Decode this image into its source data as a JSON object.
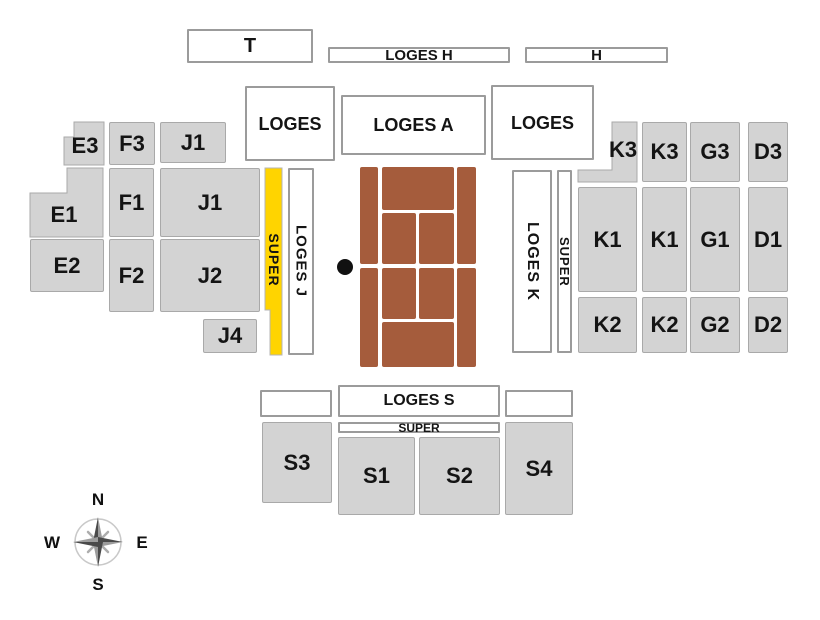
{
  "title": "Tennis stadium seating plan",
  "colors": {
    "background": "#FFFFFF",
    "section_fill": "#D3D3D3",
    "section_border": "#A9A9A9",
    "loge_fill": "#FFFFFF",
    "loge_border": "#9B9B9B",
    "super_fill": "#FFD400",
    "clay": "#A55C3C",
    "label_text": "#141414",
    "net_dot": "#111111"
  },
  "sections": [
    {
      "id": "tribune-t",
      "label": "T",
      "kind": "loge",
      "x": 187,
      "y": 29,
      "w": 126,
      "h": 34,
      "fs": 20
    },
    {
      "id": "loges-h",
      "label": "LOGES H",
      "kind": "loge",
      "x": 328,
      "y": 47,
      "w": 182,
      "h": 16,
      "fs": 15
    },
    {
      "id": "tribune-h",
      "label": "H",
      "kind": "loge",
      "x": 525,
      "y": 47,
      "w": 143,
      "h": 16,
      "fs": 15
    },
    {
      "id": "loges-nw",
      "label": "LOGES",
      "kind": "loge",
      "x": 245,
      "y": 86,
      "w": 90,
      "h": 75,
      "fs": 18
    },
    {
      "id": "loges-a",
      "label": "LOGES A",
      "kind": "loge",
      "x": 341,
      "y": 95,
      "w": 145,
      "h": 60,
      "fs": 18
    },
    {
      "id": "loges-ne",
      "label": "LOGES",
      "kind": "loge",
      "x": 491,
      "y": 85,
      "w": 103,
      "h": 75,
      "fs": 18
    },
    {
      "id": "e3",
      "label": "E3",
      "kind": "section",
      "shape": "poly",
      "points": "64,137 74,137 74,122 104,122 104,165 64,165",
      "lx": 85,
      "ly": 146,
      "fs": 22
    },
    {
      "id": "f3",
      "label": "F3",
      "kind": "section",
      "x": 109,
      "y": 122,
      "w": 46,
      "h": 43,
      "fs": 22
    },
    {
      "id": "j1-upper",
      "label": "J1",
      "kind": "section",
      "x": 160,
      "y": 122,
      "w": 66,
      "h": 41,
      "fs": 22
    },
    {
      "id": "e1",
      "label": "E1",
      "kind": "section",
      "shape": "poly",
      "points": "30,193 67,193 67,168 103,168 103,237 30,237",
      "lx": 64,
      "ly": 215,
      "fs": 22
    },
    {
      "id": "f1",
      "label": "F1",
      "kind": "section",
      "x": 109,
      "y": 168,
      "w": 45,
      "h": 69,
      "fs": 22
    },
    {
      "id": "j1",
      "label": "J1",
      "kind": "section",
      "x": 160,
      "y": 168,
      "w": 100,
      "h": 69,
      "fs": 22
    },
    {
      "id": "e2",
      "label": "E2",
      "kind": "section",
      "x": 30,
      "y": 239,
      "w": 74,
      "h": 53,
      "fs": 22
    },
    {
      "id": "f2",
      "label": "F2",
      "kind": "section",
      "x": 109,
      "y": 239,
      "w": 45,
      "h": 73,
      "fs": 22
    },
    {
      "id": "j2",
      "label": "J2",
      "kind": "section",
      "x": 160,
      "y": 239,
      "w": 100,
      "h": 73,
      "fs": 22
    },
    {
      "id": "j4",
      "label": "J4",
      "kind": "section",
      "x": 203,
      "y": 319,
      "w": 54,
      "h": 34,
      "fs": 22
    },
    {
      "id": "super-west",
      "label": "SUPER",
      "kind": "super",
      "shape": "poly",
      "points": "265,168 282,168 282,355 270,355 270,310 265,310",
      "lx": 274,
      "ly": 260,
      "fs": 14,
      "vertical": true
    },
    {
      "id": "loges-j",
      "label": "LOGES J",
      "kind": "loge",
      "x": 288,
      "y": 168,
      "w": 26,
      "h": 187,
      "fs": 15,
      "vertical": true
    },
    {
      "id": "loges-k",
      "label": "LOGES K",
      "kind": "loge",
      "x": 512,
      "y": 170,
      "w": 40,
      "h": 183,
      "fs": 16,
      "vertical": true
    },
    {
      "id": "super-east",
      "label": "SUPER",
      "kind": "loge",
      "x": 557,
      "y": 170,
      "w": 15,
      "h": 183,
      "fs": 13,
      "vertical": true
    },
    {
      "id": "k3-west",
      "label": "K3",
      "kind": "section",
      "shape": "poly",
      "points": "612,122 637,122 637,182 578,182 578,170 612,170",
      "lx": 623,
      "ly": 150,
      "fs": 22
    },
    {
      "id": "k3-east",
      "label": "K3",
      "kind": "section",
      "x": 642,
      "y": 122,
      "w": 45,
      "h": 60,
      "fs": 22
    },
    {
      "id": "g3",
      "label": "G3",
      "kind": "section",
      "x": 690,
      "y": 122,
      "w": 50,
      "h": 60,
      "fs": 22
    },
    {
      "id": "d3",
      "label": "D3",
      "kind": "section",
      "x": 748,
      "y": 122,
      "w": 40,
      "h": 60,
      "fs": 22
    },
    {
      "id": "k1-west",
      "label": "K1",
      "kind": "section",
      "x": 578,
      "y": 187,
      "w": 59,
      "h": 105,
      "fs": 22
    },
    {
      "id": "k1-east",
      "label": "K1",
      "kind": "section",
      "x": 642,
      "y": 187,
      "w": 45,
      "h": 105,
      "fs": 22
    },
    {
      "id": "g1",
      "label": "G1",
      "kind": "section",
      "x": 690,
      "y": 187,
      "w": 50,
      "h": 105,
      "fs": 22
    },
    {
      "id": "d1",
      "label": "D1",
      "kind": "section",
      "x": 748,
      "y": 187,
      "w": 40,
      "h": 105,
      "fs": 22
    },
    {
      "id": "k2-west",
      "label": "K2",
      "kind": "section",
      "x": 578,
      "y": 297,
      "w": 59,
      "h": 56,
      "fs": 22
    },
    {
      "id": "k2-east",
      "label": "K2",
      "kind": "section",
      "x": 642,
      "y": 297,
      "w": 45,
      "h": 56,
      "fs": 22
    },
    {
      "id": "g2",
      "label": "G2",
      "kind": "section",
      "x": 690,
      "y": 297,
      "w": 50,
      "h": 56,
      "fs": 22
    },
    {
      "id": "d2",
      "label": "D2",
      "kind": "section",
      "x": 748,
      "y": 297,
      "w": 40,
      "h": 56,
      "fs": 22
    },
    {
      "id": "loge-s-west",
      "label": "",
      "kind": "loge",
      "x": 260,
      "y": 390,
      "w": 72,
      "h": 27
    },
    {
      "id": "loges-s",
      "label": "LOGES S",
      "kind": "loge",
      "x": 338,
      "y": 385,
      "w": 162,
      "h": 32,
      "fs": 16
    },
    {
      "id": "loge-s-east",
      "label": "",
      "kind": "loge",
      "x": 505,
      "y": 390,
      "w": 68,
      "h": 27
    },
    {
      "id": "super-south",
      "label": "SUPER",
      "kind": "loge",
      "x": 338,
      "y": 422,
      "w": 162,
      "h": 11,
      "fs": 12
    },
    {
      "id": "s3",
      "label": "S3",
      "kind": "section",
      "x": 262,
      "y": 422,
      "w": 70,
      "h": 81,
      "fs": 22
    },
    {
      "id": "s1",
      "label": "S1",
      "kind": "section",
      "x": 338,
      "y": 437,
      "w": 77,
      "h": 78,
      "fs": 22
    },
    {
      "id": "s2",
      "label": "S2",
      "kind": "section",
      "x": 419,
      "y": 437,
      "w": 81,
      "h": 78,
      "fs": 22
    },
    {
      "id": "s4",
      "label": "S4",
      "kind": "section",
      "x": 505,
      "y": 422,
      "w": 68,
      "h": 93,
      "fs": 22
    }
  ],
  "court": {
    "segments": [
      {
        "name": "alley-left-north",
        "x": 360,
        "y": 167,
        "w": 18,
        "h": 97
      },
      {
        "name": "backcourt-north",
        "x": 382,
        "y": 167,
        "w": 72,
        "h": 43
      },
      {
        "name": "service-nw",
        "x": 382,
        "y": 213,
        "w": 34,
        "h": 51
      },
      {
        "name": "service-ne",
        "x": 419,
        "y": 213,
        "w": 35,
        "h": 51
      },
      {
        "name": "alley-right-north",
        "x": 457,
        "y": 167,
        "w": 19,
        "h": 97
      },
      {
        "name": "alley-left-south",
        "x": 360,
        "y": 268,
        "w": 18,
        "h": 99
      },
      {
        "name": "service-sw",
        "x": 382,
        "y": 268,
        "w": 34,
        "h": 51
      },
      {
        "name": "service-se",
        "x": 419,
        "y": 268,
        "w": 35,
        "h": 51
      },
      {
        "name": "backcourt-south",
        "x": 382,
        "y": 322,
        "w": 72,
        "h": 45
      },
      {
        "name": "alley-right-south",
        "x": 457,
        "y": 268,
        "w": 19,
        "h": 99
      }
    ],
    "net_dot": {
      "cx": 345,
      "cy": 267,
      "r": 8
    }
  },
  "compass": {
    "north": "N",
    "east": "E",
    "south": "S",
    "west": "W"
  }
}
